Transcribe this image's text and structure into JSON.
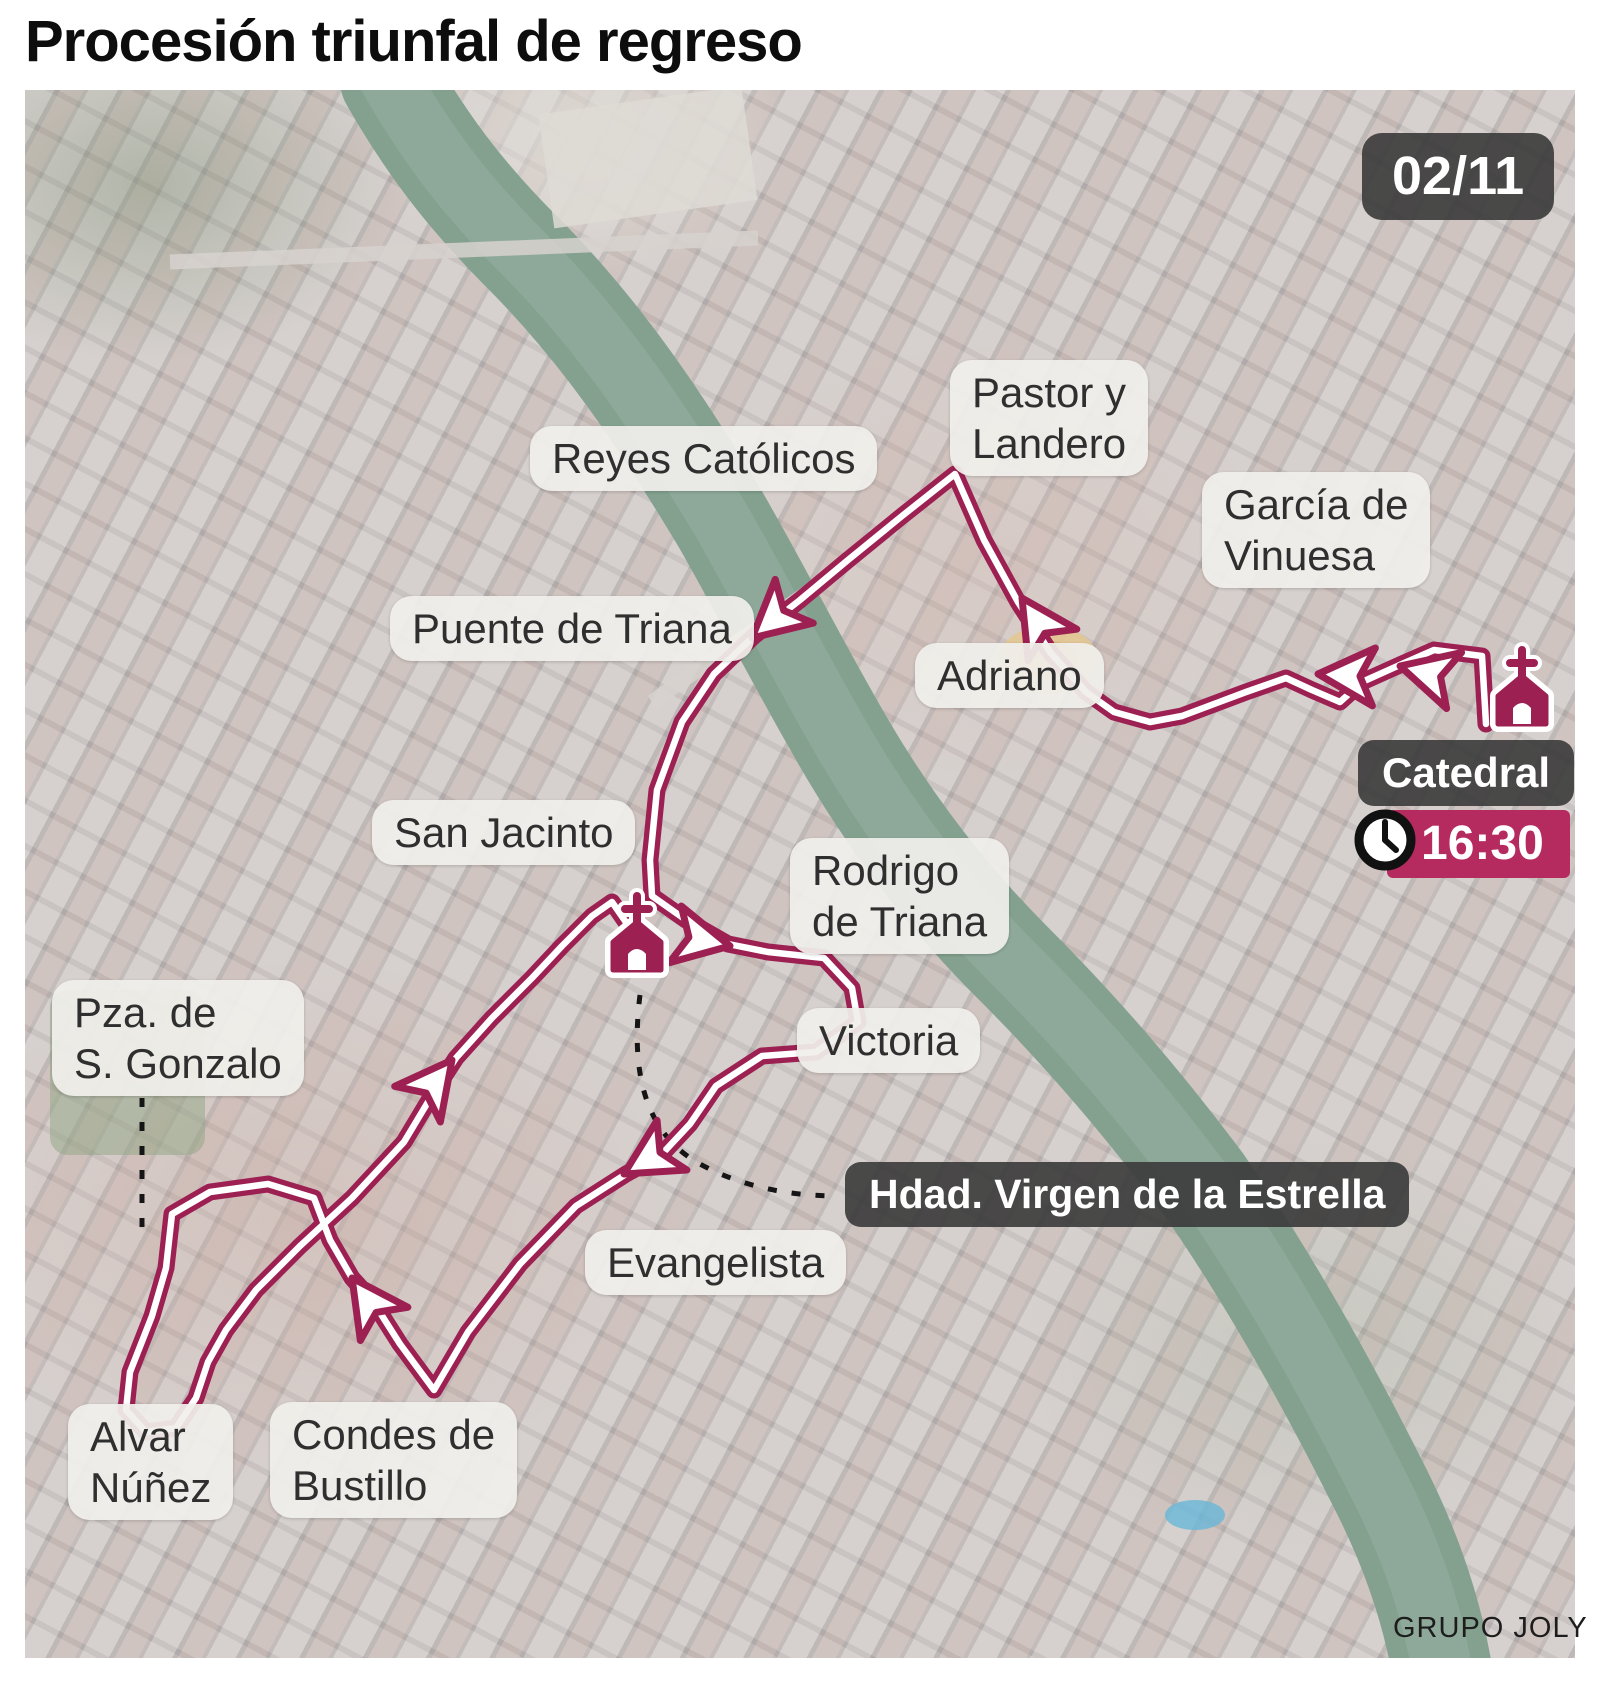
{
  "title": "Procesión triunfal de regreso",
  "date_badge": "02/11",
  "credit": "GRUPO JOLY",
  "destination": {
    "label": "Catedral",
    "time": "16:30"
  },
  "brotherhood": {
    "label": "Hdad. Virgen de la Estrella"
  },
  "colors": {
    "route": "#9c2152",
    "route_core": "#ffffff",
    "time_badge": "#b52b60",
    "dark_badge": "#3a3a3a",
    "pill_bg": "#f0efeb",
    "river": "#84a18f",
    "title_text": "#0d0d0d"
  },
  "street_labels": [
    {
      "id": "reyes-catolicos",
      "lines": [
        "Reyes Católicos"
      ],
      "x": 530,
      "y": 426
    },
    {
      "id": "pastor-y-landero",
      "lines": [
        "Pastor y",
        "Landero"
      ],
      "x": 950,
      "y": 360
    },
    {
      "id": "garcia-de-vinuesa",
      "lines": [
        "García de",
        "Vinuesa"
      ],
      "x": 1202,
      "y": 472
    },
    {
      "id": "puente-de-triana",
      "lines": [
        "Puente de Triana"
      ],
      "x": 390,
      "y": 596
    },
    {
      "id": "adriano",
      "lines": [
        "Adriano"
      ],
      "x": 915,
      "y": 643
    },
    {
      "id": "san-jacinto",
      "lines": [
        "San Jacinto"
      ],
      "x": 372,
      "y": 800
    },
    {
      "id": "rodrigo-de-triana",
      "lines": [
        "Rodrigo",
        "de Triana"
      ],
      "x": 790,
      "y": 838
    },
    {
      "id": "victoria",
      "lines": [
        "Victoria"
      ],
      "x": 797,
      "y": 1008
    },
    {
      "id": "pza-de-s-gonzalo",
      "lines": [
        "Pza. de",
        "S. Gonzalo"
      ],
      "x": 52,
      "y": 980
    },
    {
      "id": "evangelista",
      "lines": [
        "Evangelista"
      ],
      "x": 585,
      "y": 1230
    },
    {
      "id": "alvar-nunez",
      "lines": [
        "Alvar",
        "Núñez"
      ],
      "x": 68,
      "y": 1404
    },
    {
      "id": "condes-de-bustillo",
      "lines": [
        "Condes de",
        "Bustillo"
      ],
      "x": 270,
      "y": 1402
    }
  ],
  "route": {
    "points": "1486,724 1482,656 1434,650 1402,664 1362,682 1340,702 1312,690 1286,678 1246,692 1214,704 1182,716 1150,722 1114,712 1086,692 1050,652 1018,602 984,540 955,474 902,516 848,560 800,600 754,636 714,674 682,722 657,790 650,860 652,896 686,920 728,944 768,952 824,958 852,988 858,1022 816,1052 762,1056 716,1086 690,1124 662,1154 626,1174 576,1206 520,1264 468,1332 434,1390 400,1344 372,1300 352,1278 330,1240 314,1198 268,1184 210,1192 172,1214 166,1268 152,1316 130,1372 126,1410 146,1432 176,1428 196,1398 208,1362 226,1330 256,1290 300,1246 352,1198 404,1142 434,1092 456,1058 492,1018 532,978 562,946 592,916 612,902 630,928 640,958",
    "arrows": [
      {
        "x": 1400,
        "y": 666,
        "a": 195
      },
      {
        "x": 1318,
        "y": 674,
        "a": 183
      },
      {
        "x": 1022,
        "y": 598,
        "a": 237
      },
      {
        "x": 752,
        "y": 638,
        "a": 139
      },
      {
        "x": 730,
        "y": 946,
        "a": 12
      },
      {
        "x": 624,
        "y": 1174,
        "a": 149
      },
      {
        "x": 352,
        "y": 1278,
        "a": 235
      },
      {
        "x": 452,
        "y": 1060,
        "a": 308
      }
    ],
    "church_icons": [
      {
        "x": 1522,
        "y": 712,
        "name": "catedral-church-icon"
      },
      {
        "x": 637,
        "y": 958,
        "name": "chapel-church-icon"
      }
    ],
    "dashed_connectors": [
      "M 142,1098 L 142,1235",
      "M 640,995 C 628,1090 656,1140 700,1164 C 740,1186 788,1196 838,1196"
    ]
  }
}
